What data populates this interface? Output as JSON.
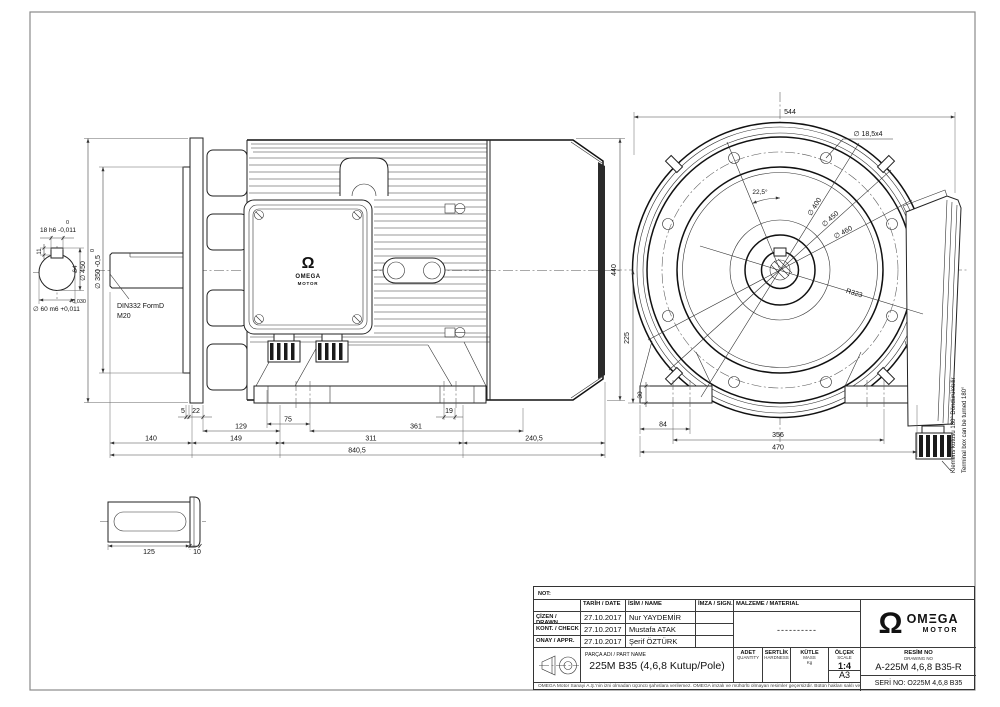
{
  "sheet": {
    "bg": "#ffffff",
    "line_color": "#222222",
    "accent_dark": "#2b2b2b"
  },
  "side_view": {
    "dims": {
      "a5": "5",
      "a22": "22",
      "a19": "19",
      "a75": "75",
      "a129": "129",
      "a361": "361",
      "a140": "140",
      "a149": "149",
      "a311": "311",
      "a240_5": "240,5",
      "a840_5": "840,5",
      "height_440": "440"
    },
    "shaft": {
      "key_upper": "0",
      "key": "18 h6 -0,011",
      "k11": "11",
      "k64": "64",
      "flange_od": "∅ 450",
      "spigot_upper": "0",
      "spigot": "∅ 350 -0,5",
      "tol_upper": "+0,030",
      "shaft_dia": "∅ 60 m6 +0,011",
      "center1": "DIN332 FormD",
      "center2": "M20"
    },
    "box_logo": {
      "symbol": "Ω",
      "name": "OMEGA",
      "sub": "MOTOR"
    }
  },
  "front_view": {
    "dims": {
      "width": "544",
      "holes": "∅ 18,5x4",
      "angle": "22,5°",
      "d400": "∅ 400",
      "d450": "∅ 450",
      "d460": "∅ 460",
      "r323": "R323",
      "h225": "225",
      "h30": "30",
      "f84": "84",
      "f356": "356",
      "f470": "470"
    },
    "note_tr": "Klemens kutusu 180° Döndürülebilir",
    "note_en": "Terminal box can be turned 180°"
  },
  "detail_view": {
    "dims": {
      "len": "125",
      "w10": "10"
    }
  },
  "title_block": {
    "not_label": "NOT:",
    "col_headers": {
      "tarih": "TARİH / DATE",
      "isim": "İSİM / NAME",
      "imza": "İMZA / SIGN.",
      "malzeme": "MALZEME / MATERIAL"
    },
    "rows": [
      {
        "label": "ÇİZEN / DRAWN",
        "date": "27.10.2017",
        "name": "Nur YAYDEMİR"
      },
      {
        "label": "KONT. / CHECK",
        "date": "27.10.2017",
        "name": "Mustafa ATAK"
      },
      {
        "label": "ONAY / APPR.",
        "date": "27.10.2017",
        "name": "Şerif ÖZTÜRK"
      }
    ],
    "malzeme_value": "----------",
    "parca_label": "PARÇA ADI / PART NAME",
    "part_name": "225M  B35 (4,6,8 Kutup/Pole)",
    "adet": "ADET",
    "adet_sub": "QUANTITY",
    "sertlik": "SERTLİK",
    "sertlik_sub": "HARDNESS",
    "kutle": "KÜTLE",
    "kutle_sub": "MASS",
    "kutle_unit": "Kg",
    "olcek": "ÖLÇEK",
    "olcek_sub": "SCALE",
    "scale_value": "1:4",
    "paper_size": "A3",
    "resim_label": "RESİM NO",
    "resim_sub": "DRAWING NO",
    "drawing_no": "A-225M 4,6,8 B35-R",
    "seri_no": "SERİ NO: O225M  4,6,8 B35",
    "disclaimer": "OMEGA Motor Sanayi A.Ş.'nin izni olmadan üçüncü şahıslara verilemez. OMEGA imzalı ve mühürlü olmayan resimler geçersizdir. Bütün hakları saklı ve gizlidir.",
    "logo": {
      "symbol": "Ω",
      "name": "OMΞGA",
      "sub": "MOTOR"
    }
  }
}
